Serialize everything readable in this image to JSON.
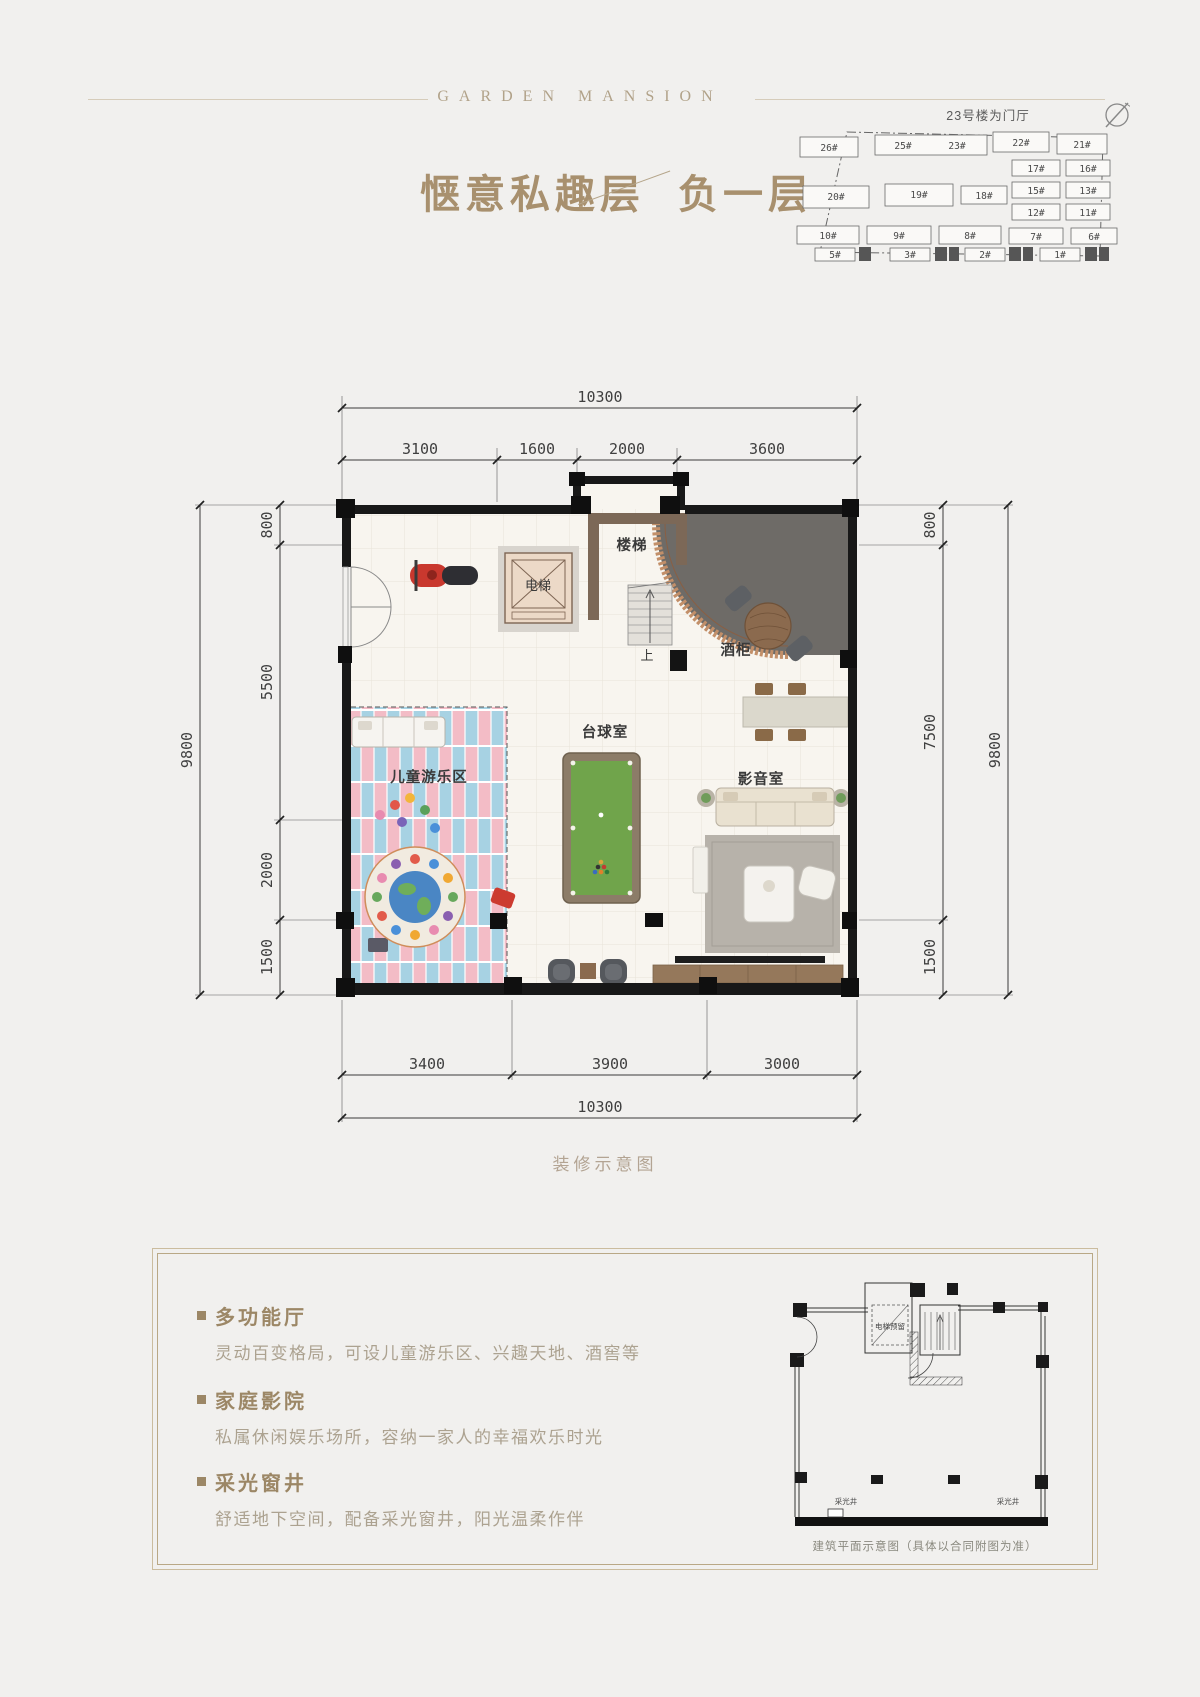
{
  "header": {
    "brand": "GARDEN MANSION"
  },
  "title": {
    "main": "惬意私趣层",
    "sub": "负一层"
  },
  "site_plan": {
    "note": "23号楼为门厅",
    "buildings": [
      "26#",
      "25#",
      "23#",
      "22#",
      "21#",
      "17#",
      "16#",
      "20#",
      "19#",
      "18#",
      "15#",
      "13#",
      "12#",
      "11#",
      "10#",
      "9#",
      "8#",
      "7#",
      "6#",
      "5#",
      "3#",
      "2#",
      "1#"
    ]
  },
  "floor_plan": {
    "rooms": {
      "elevator": "电梯",
      "stairs": "楼梯",
      "stairs_up": "上",
      "wine_cabinet": "酒柜",
      "billiards_room": "台球室",
      "media_room": "影音室",
      "kids_zone": "儿童游乐区"
    },
    "dims": {
      "top_overall": "10300",
      "top_segments": [
        "3100",
        "1600",
        "2000",
        "3600"
      ],
      "left_overall": "9800",
      "left_segments": [
        "800",
        "5500",
        "2000",
        "1500"
      ],
      "right_overall": "9800",
      "right_segments": [
        "800",
        "7500",
        "1500"
      ],
      "bottom_segments": [
        "3400",
        "3900",
        "3000"
      ],
      "bottom_overall": "10300"
    },
    "caption": "装修示意图"
  },
  "features": [
    {
      "title": "多功能厅",
      "desc": "灵动百变格局，可设儿童游乐区、兴趣天地、酒窖等"
    },
    {
      "title": "家庭影院",
      "desc": "私属休闲娱乐场所，容纳一家人的幸福欢乐时光"
    },
    {
      "title": "采光窗井",
      "desc": "舒适地下空间，配备采光窗井，阳光温柔作伴"
    }
  ],
  "tech_plan": {
    "elevator_note": "电梯预留",
    "light_well_left": "采光井",
    "light_well_right": "采光井",
    "caption": "建筑平面示意图（具体以合同附图为准）"
  },
  "colors": {
    "accent": "#a8906e",
    "wall": "#181818",
    "carpet_pink": "#f3bcc6",
    "carpet_blue": "#a7d2e3",
    "pool_felt": "#70a44b"
  }
}
